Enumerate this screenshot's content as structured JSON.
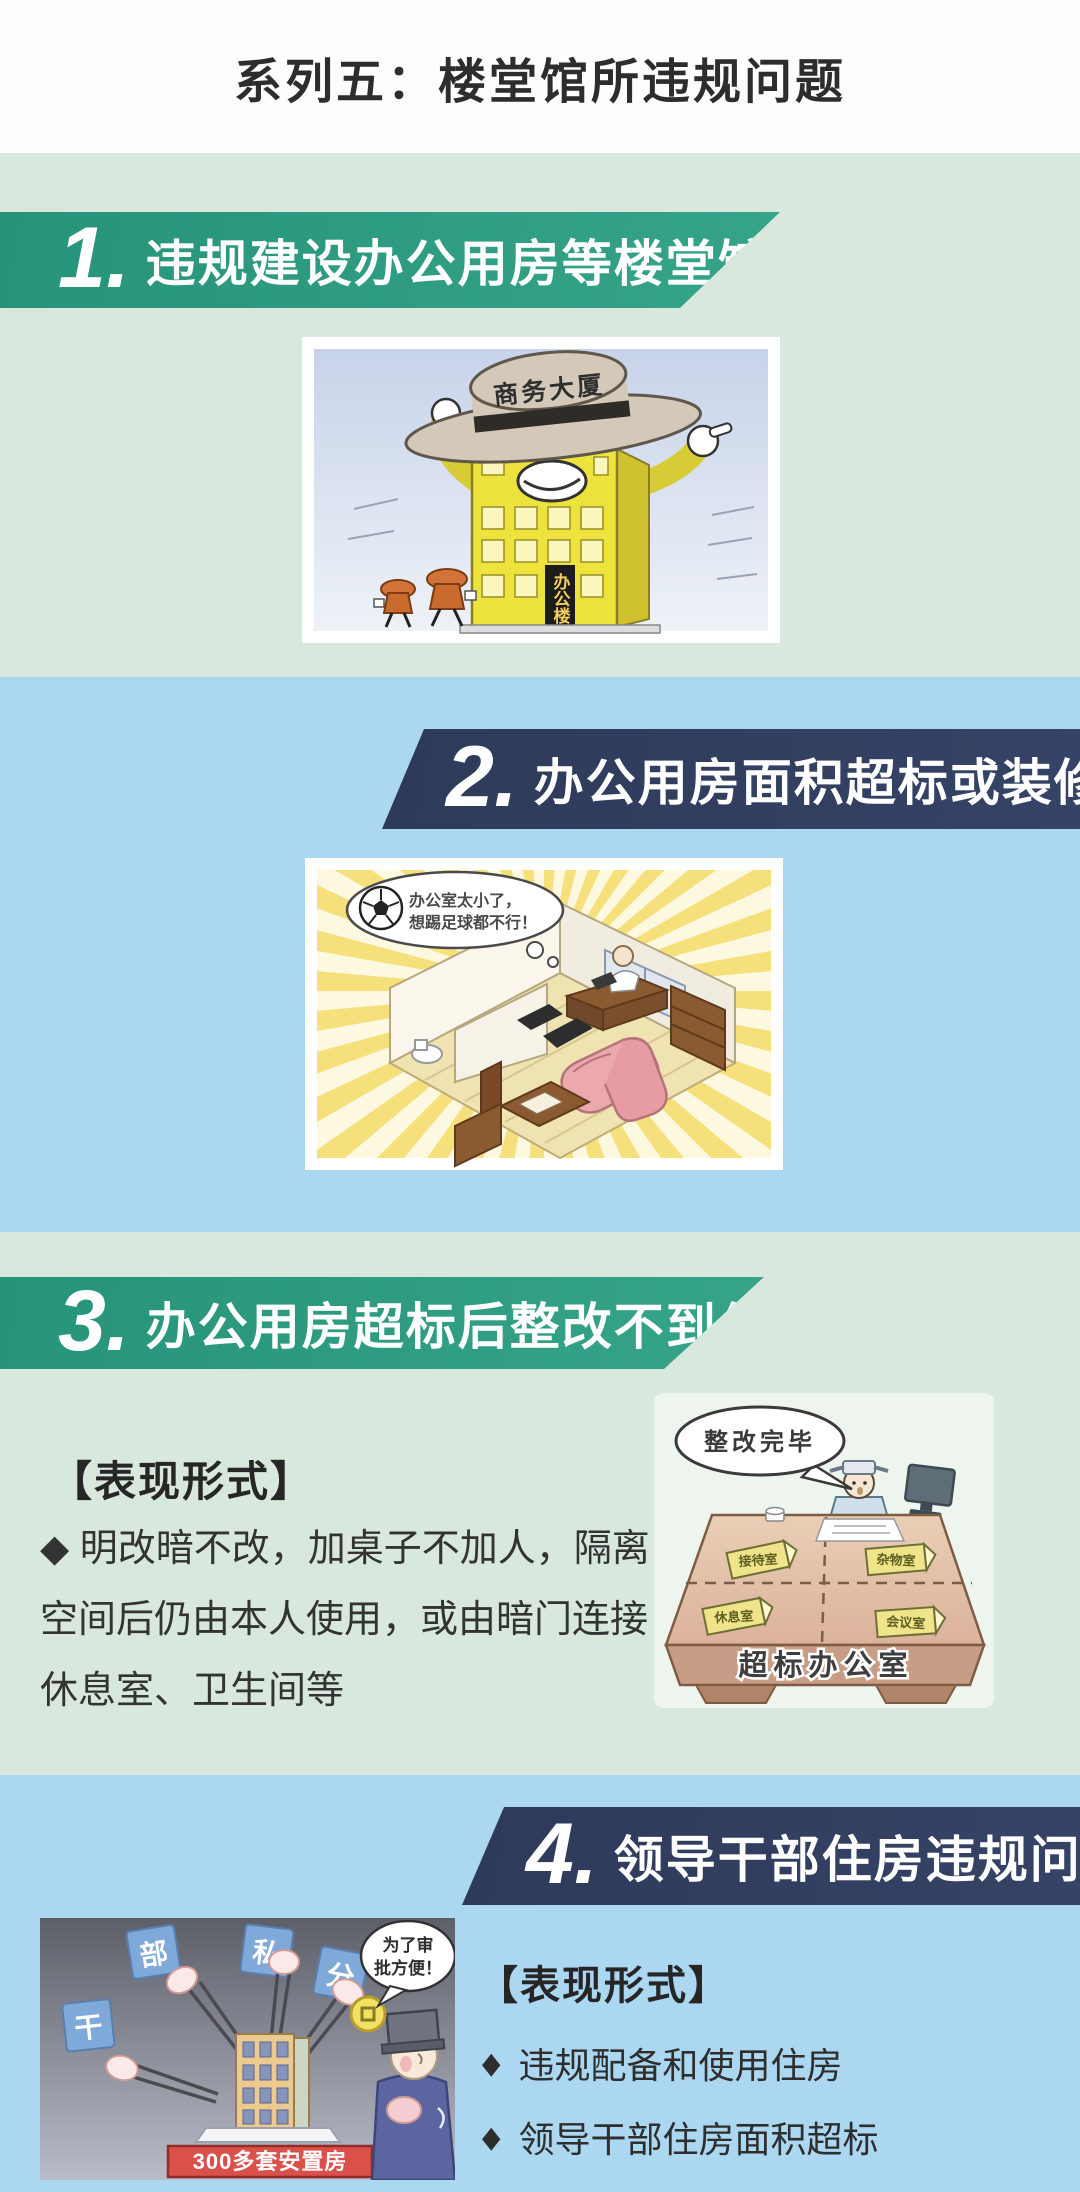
{
  "page_title": "系列五：楼堂馆所违规问题",
  "bullet_icon": "◆",
  "colors": {
    "green_bg": "#d9e8dc",
    "blue_bg": "#abd7f1",
    "teal_banner": "#2b9478",
    "navy_banner": "#323f5f",
    "banner_text": "#ffffff",
    "body_text": "#333333",
    "red_banner": "#d9514a"
  },
  "sections": [
    {
      "number": "1.",
      "title": "违规建设办公用房等楼堂馆所"
    },
    {
      "number": "2.",
      "title": "办公用房面积超标或装修超标"
    },
    {
      "number": "3.",
      "title": "办公用房超标后整改不到位",
      "heading": "【表现形式】",
      "bullet": "◆ 明改暗不改，加桌子不加人，隔离空间后仍由本人使用，或由暗门连接休息室、卫生间等"
    },
    {
      "number": "4.",
      "title": "领导干部住房违规问题",
      "heading": "【表现形式】",
      "bullets": [
        "违规配备和使用住房",
        "领导干部住房面积超标"
      ]
    }
  ],
  "illustrations": {
    "building_hat": {
      "hat_label": "商务大厦",
      "sign": "办公楼"
    },
    "office_room": {
      "bubble_line1": "办公室太小了，",
      "bubble_line2": "想踢足球都不行！"
    },
    "desk": {
      "bubble": "整改完毕",
      "front_label": "超标办公室",
      "cards": [
        "接待室",
        "杂物室",
        "休息室",
        "会议室"
      ]
    },
    "housing": {
      "tags": [
        "干",
        "部",
        "私",
        "分"
      ],
      "banner": "300多套安置房",
      "bubble_line1": "为了审",
      "bubble_line2": "批方便！"
    }
  }
}
